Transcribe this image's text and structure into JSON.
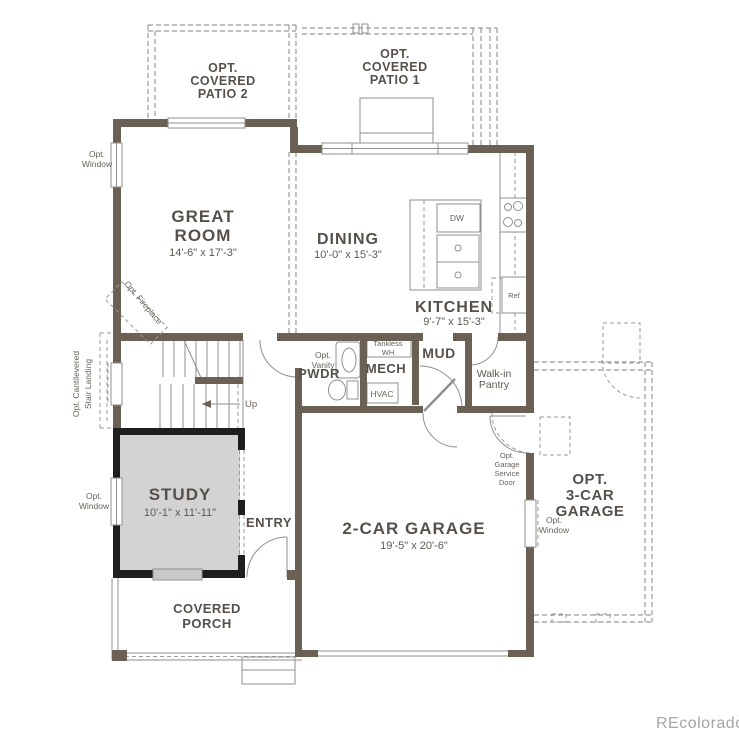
{
  "title": "First Floor Plan",
  "colors": {
    "wall": "#6b6054",
    "black_wall": "#1f1e1c",
    "study_fill": "#d3d3d3",
    "label_text": "#57504a",
    "thin_line": "#8f8f8f",
    "watermark": "#a5a5a5"
  },
  "rooms": {
    "great_room": {
      "line1": "GREAT",
      "line2": "ROOM",
      "dims": "14'-6\" x 17'-3\""
    },
    "dining": {
      "name": "DINING",
      "dims": "10'-0\" x 15'-3\""
    },
    "kitchen": {
      "name": "KITCHEN",
      "dims": "9'-7\" x 15'-3\""
    },
    "study": {
      "name": "STUDY",
      "dims": "10'-1\" x 11'-11\""
    },
    "garage": {
      "name": "2-CAR GARAGE",
      "dims": "19'-5\" x 20'-6\""
    },
    "opt_garage": {
      "line1": "OPT.",
      "line2": "3-CAR",
      "line3": "GARAGE"
    },
    "patio1": {
      "line1": "OPT.",
      "line2": "COVERED",
      "line3": "PATIO 1"
    },
    "patio2": {
      "line1": "OPT.",
      "line2": "COVERED",
      "line3": "PATIO 2"
    },
    "porch": {
      "line1": "COVERED",
      "line2": "PORCH"
    },
    "entry": {
      "name": "ENTRY"
    },
    "pwdr": {
      "name": "PWDR"
    },
    "mech": {
      "name": "MECH"
    },
    "mud": {
      "name": "MUD"
    },
    "pantry": {
      "line1": "Walk-in",
      "line2": "Pantry"
    }
  },
  "annotations": {
    "opt_window_line1": "Opt.",
    "opt_window_line2": "Window",
    "opt_vanity_line1": "Opt.",
    "opt_vanity_line2": "Vanity",
    "opt_fireplace": "Opt. Fireplace",
    "opt_cantilevered_line1": "Opt. Cantilevered",
    "opt_cantilevered_line2": "Stair Landing",
    "service_door_line1": "Opt.",
    "service_door_line2": "Garage",
    "service_door_line3": "Service",
    "service_door_line4": "Door",
    "tankless_line1": "Tankless",
    "tankless_line2": "WH",
    "hvac": "HVAC",
    "dw": "DW",
    "ref": "Ref",
    "up": "Up"
  },
  "watermark": "REcolorado"
}
